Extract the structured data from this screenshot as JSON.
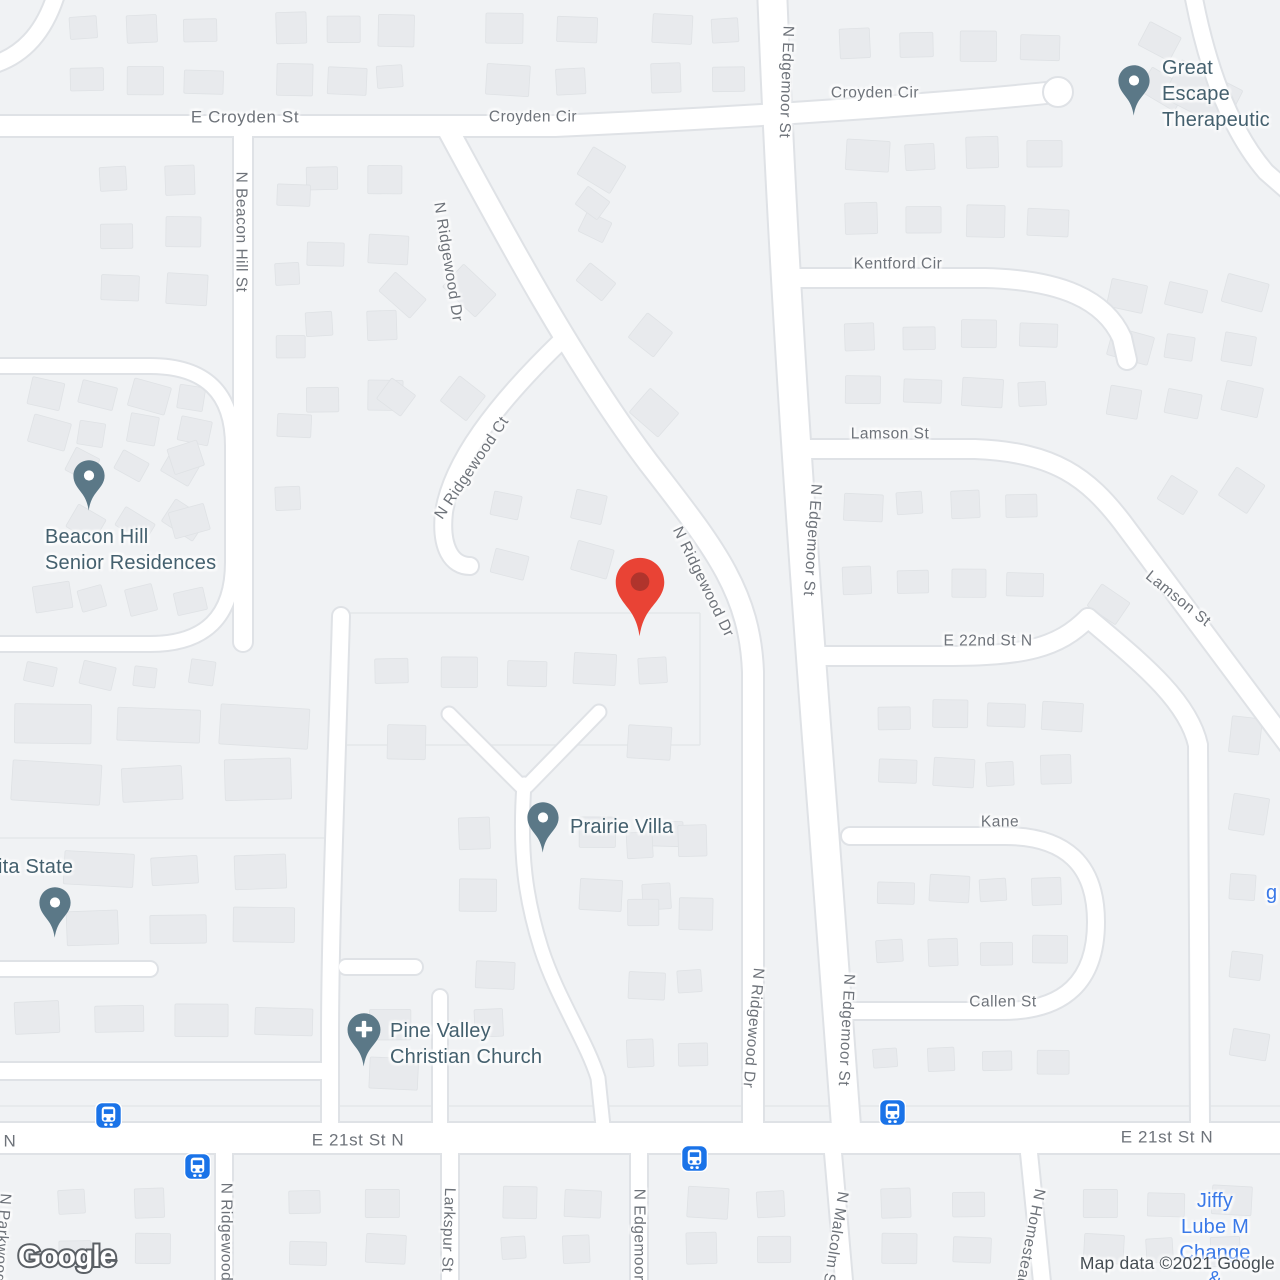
{
  "map": {
    "logo_text": "Google",
    "attribution": "Map data ©2021 Google",
    "colors": {
      "destination_pin": "#E94335",
      "destination_pin_inner": "#B0342C",
      "poi_pin": "#5B7887",
      "transit_blue": "#1A73E8",
      "business_text": "#3A79E8",
      "poi_text": "#44606E",
      "street_text": "#6E737A"
    },
    "street_labels": [
      {
        "text": "E Croyden St",
        "x": 245,
        "y": 117,
        "rot": 0,
        "size": "lg"
      },
      {
        "text": "Croyden Cir",
        "x": 533,
        "y": 117,
        "rot": 0,
        "size": "st"
      },
      {
        "text": "Croyden Cir",
        "x": 875,
        "y": 93,
        "rot": 0,
        "size": "st"
      },
      {
        "text": "N Beacon Hill St",
        "x": 241,
        "y": 232,
        "rot": 90,
        "size": "st"
      },
      {
        "text": "N Ridgewood Dr",
        "x": 448,
        "y": 262,
        "rot": 81,
        "size": "st"
      },
      {
        "text": "N Ridgewood Ct",
        "x": 472,
        "y": 468,
        "rot": -56,
        "size": "st"
      },
      {
        "text": "N Edgemoor St",
        "x": 786,
        "y": 82,
        "rot": 92,
        "size": "st"
      },
      {
        "text": "Kentford Cir",
        "x": 898,
        "y": 264,
        "rot": 0,
        "size": "st"
      },
      {
        "text": "Lamson St",
        "x": 890,
        "y": 434,
        "rot": 0,
        "size": "st"
      },
      {
        "text": "N Edgemoor St",
        "x": 812,
        "y": 540,
        "rot": 94,
        "size": "st"
      },
      {
        "text": "E 22nd St N",
        "x": 988,
        "y": 641,
        "rot": 0,
        "size": "st"
      },
      {
        "text": "Lamson St",
        "x": 1178,
        "y": 599,
        "rot": 39,
        "size": "st"
      },
      {
        "text": "N Ridgewood Dr",
        "x": 703,
        "y": 582,
        "rot": 64,
        "size": "st"
      },
      {
        "text": "Kane",
        "x": 1000,
        "y": 822,
        "rot": 0,
        "size": "st"
      },
      {
        "text": "Callen St",
        "x": 1003,
        "y": 1002,
        "rot": 0,
        "size": "st"
      },
      {
        "text": "N Ridgewood Dr",
        "x": 753,
        "y": 1028,
        "rot": 95,
        "size": "st"
      },
      {
        "text": "N Edgemoor St",
        "x": 846,
        "y": 1030,
        "rot": 93,
        "size": "st"
      },
      {
        "text": "E 21st St N",
        "x": 358,
        "y": 1140,
        "rot": 0,
        "size": "lg"
      },
      {
        "text": "E 21st St N",
        "x": 1167,
        "y": 1137,
        "rot": 0,
        "size": "lg"
      },
      {
        "text": "N",
        "x": 10,
        "y": 1141,
        "rot": 0,
        "size": "lg"
      },
      {
        "text": "N Ridgewood",
        "x": 226,
        "y": 1232,
        "rot": 90,
        "size": "st"
      },
      {
        "text": "Larkspur St",
        "x": 448,
        "y": 1230,
        "rot": 92,
        "size": "st"
      },
      {
        "text": "N Edgemoor St",
        "x": 639,
        "y": 1245,
        "rot": 90,
        "size": "st"
      },
      {
        "text": "N Malcolm St",
        "x": 835,
        "y": 1240,
        "rot": 99,
        "size": "st"
      },
      {
        "text": "N Homestead",
        "x": 1030,
        "y": 1238,
        "rot": 101,
        "size": "st"
      },
      {
        "text": "N Parkwood",
        "x": 2,
        "y": 1238,
        "rot": 94,
        "size": "st"
      }
    ],
    "pois": [
      {
        "id": "great-escape-therapeutic",
        "lines": [
          "Great Escape",
          "Therapeutic"
        ],
        "pin": {
          "x": 1134,
          "y": 118,
          "icon": "dot"
        },
        "label": {
          "x": 1162,
          "y": 94,
          "align": "left"
        },
        "business": false
      },
      {
        "id": "beacon-hill-senior-residences",
        "lines": [
          "Beacon Hill",
          "Senior Residences"
        ],
        "pin": {
          "x": 89,
          "y": 513,
          "icon": "dot"
        },
        "label": {
          "x": 45,
          "y": 550,
          "align": "left"
        },
        "business": false
      },
      {
        "id": "prairie-villa",
        "lines": [
          "Prairie Villa"
        ],
        "pin": {
          "x": 543,
          "y": 855,
          "icon": "dot"
        },
        "label": {
          "x": 570,
          "y": 827,
          "align": "left"
        },
        "business": false
      },
      {
        "id": "ita-state",
        "lines": [
          "ita State"
        ],
        "pin": {
          "x": 55,
          "y": 940,
          "icon": "dot"
        },
        "label": {
          "x": -2,
          "y": 867,
          "align": "left"
        },
        "business": false
      },
      {
        "id": "pine-valley-christian-church",
        "lines": [
          "Pine Valley",
          "Christian Church"
        ],
        "pin": {
          "x": 364,
          "y": 1069,
          "icon": "cross"
        },
        "label": {
          "x": 390,
          "y": 1044,
          "align": "left"
        },
        "business": false
      },
      {
        "id": "jiffy-lube",
        "lines": [
          "Jiffy Lube M",
          "Change &"
        ],
        "pin": null,
        "label": {
          "x": 1215,
          "y": 1240,
          "align": "center"
        },
        "business": true
      },
      {
        "id": "partial-business-label",
        "lines": [
          "g"
        ],
        "pin": null,
        "label": {
          "x": 1266,
          "y": 893,
          "align": "left"
        },
        "business": true
      }
    ],
    "destination_pin": {
      "x": 640,
      "y": 640
    },
    "transit_stops": [
      {
        "x": 108,
        "y": 1115
      },
      {
        "x": 197,
        "y": 1166
      },
      {
        "x": 694,
        "y": 1158
      },
      {
        "x": 892,
        "y": 1112
      }
    ]
  }
}
